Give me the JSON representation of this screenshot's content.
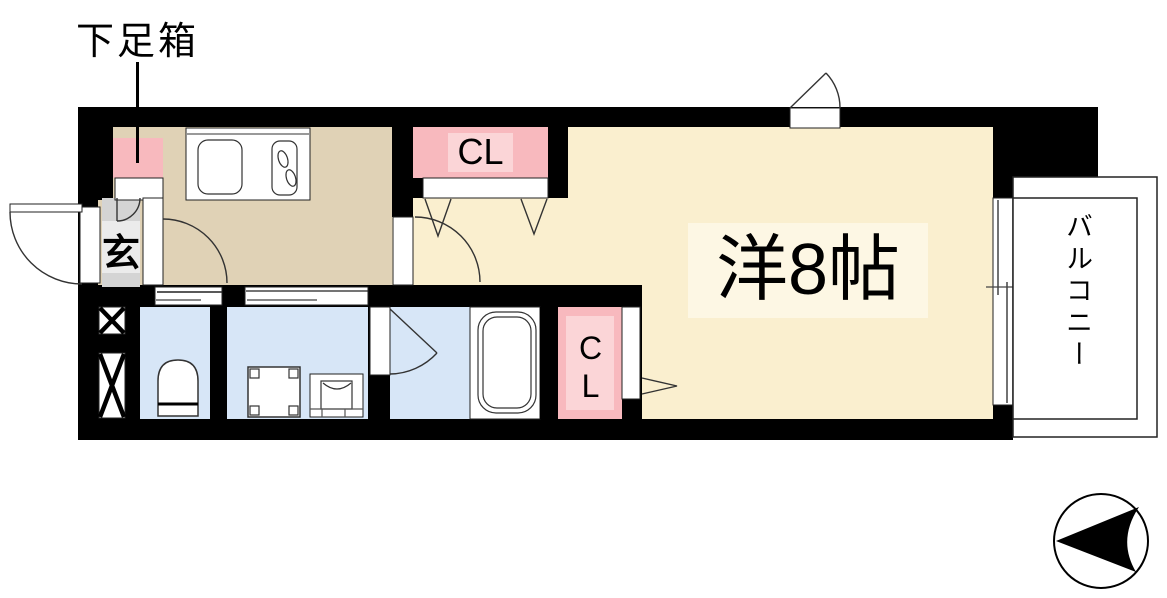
{
  "title": "ワンルーム間取り図",
  "labels": {
    "shoe_box": "下足箱",
    "entrance": "玄",
    "closet_top": "CL",
    "closet_bottom": "CL",
    "main_room": "洋8帖",
    "balcony": "バルコニー"
  },
  "colors": {
    "wall": "#000000",
    "main_room_floor": "#FAEFCF",
    "main_room_label_bg": "#FDF7E4",
    "kitchen_floor": "#E0D2B6",
    "wet_area_floor": "#D7E6F7",
    "closet_pink": "#F8B9BE",
    "closet_pink_light": "#FBD5D7",
    "entrance_gray": "#D4D4D4",
    "entrance_gray_light": "#EBEBEB",
    "balcony_fill": "#FFFFFF"
  },
  "fixtures": [
    "shoe-box",
    "entrance-door",
    "kitchen-counter",
    "kitchen-sink",
    "gas-stove",
    "closet-folding-door",
    "pipe-shaft",
    "toilet",
    "washing-machine-pan",
    "washbasin",
    "bathtub",
    "sliding-window",
    "balcony",
    "compass-north-arrow"
  ]
}
